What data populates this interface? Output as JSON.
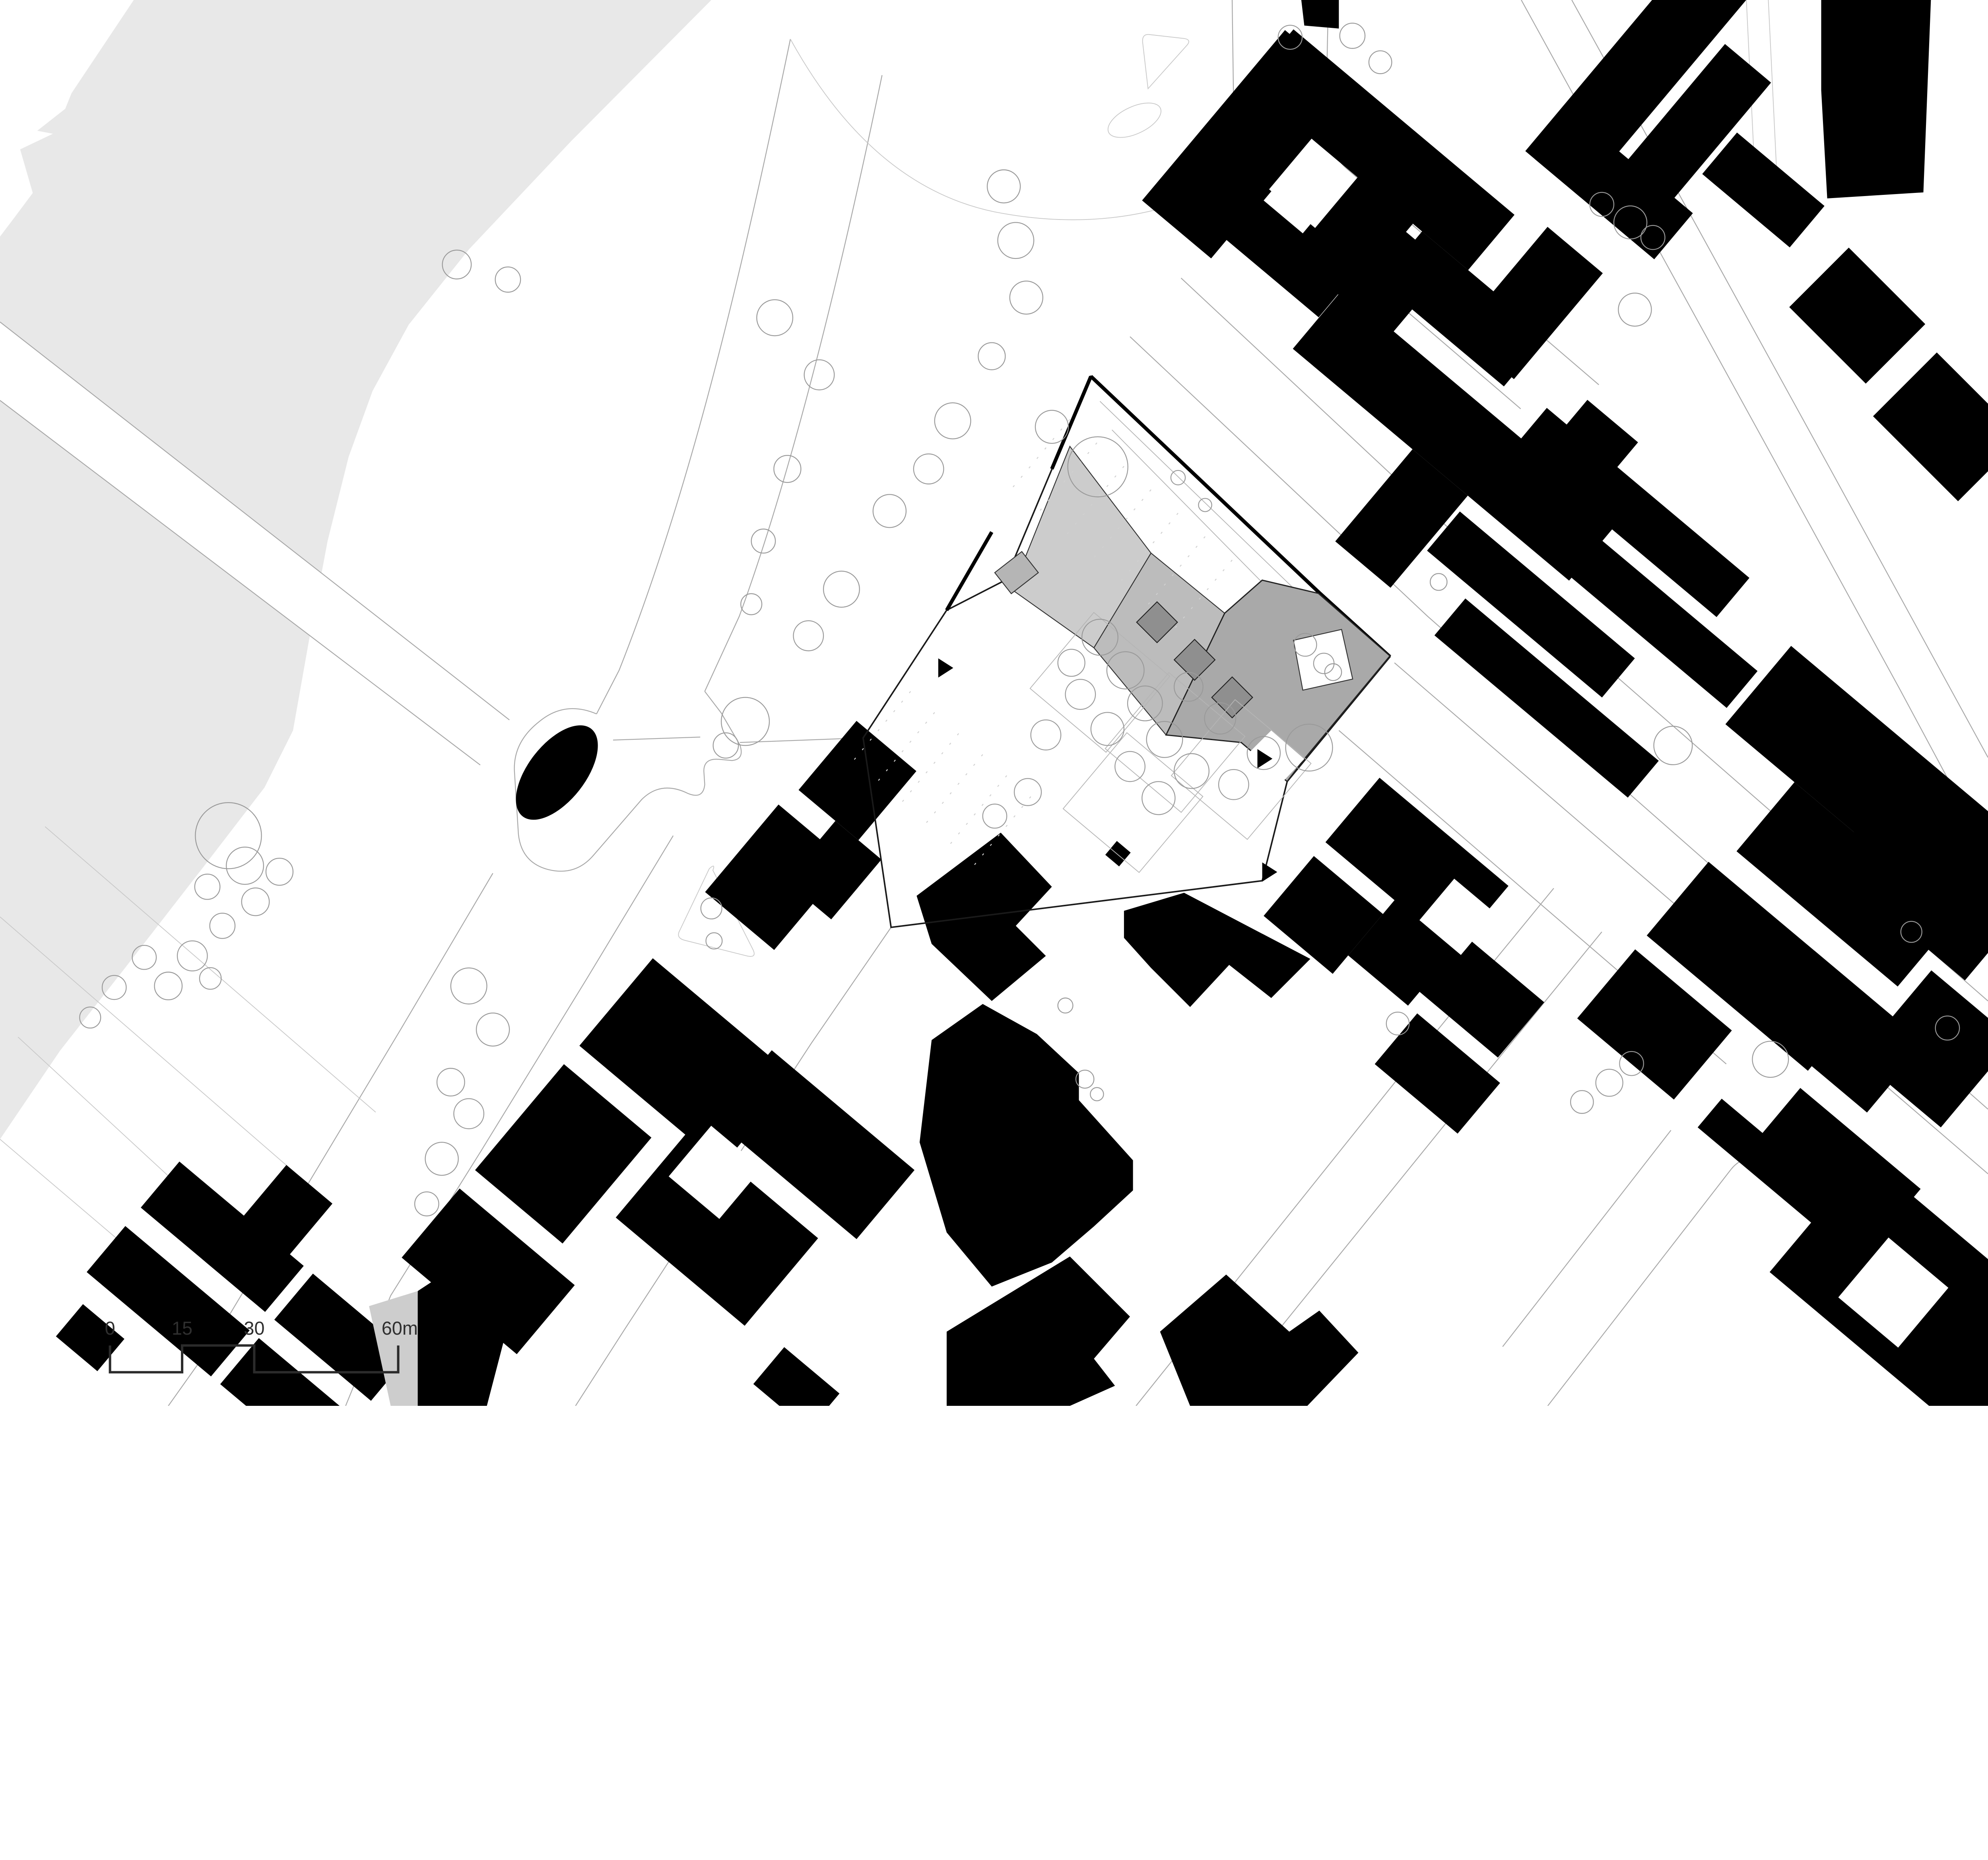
{
  "document": {
    "type": "architectural-site-plan",
    "style": "figure-ground black plan with highlighted project site"
  },
  "scale_bar": {
    "labels": [
      "0",
      "15",
      "30",
      "60m"
    ],
    "values_m": [
      0,
      15,
      30,
      60
    ],
    "unit": "m"
  },
  "colors": {
    "background": "#ffffff",
    "water": "#e8e8e8",
    "building_footprint": "#000000",
    "site_roof_light": "#cccccc",
    "site_roof_mid": "#bcbcbc",
    "site_roof_dark": "#a9a9a9",
    "skylight": "#8f8f8f",
    "tree_outline": "#9a9a9a",
    "road_line": "#a8a8a8",
    "scale_bar": "#2b2b2b"
  },
  "features": {
    "river": "water / river band (top left)",
    "boulevard": "diagonal boulevard with tree rows",
    "site": "project site with terraced grey roofs and courtyard garden",
    "island": "traffic island with black monument oval",
    "buildings": "existing building footprints (black)",
    "scale": "stepped graphic scale bar"
  },
  "trees": [
    [
      2578,
      1057,
      60
    ],
    [
      2726,
      1247,
      50
    ],
    [
      2620,
      1560,
      45
    ],
    [
      2540,
      1800,
      40
    ],
    [
      2500,
      2010,
      35
    ],
    [
      2480,
      2400,
      80
    ],
    [
      2415,
      2480,
      42
    ],
    [
      3340,
      620,
      55
    ],
    [
      3380,
      800,
      60
    ],
    [
      3415,
      990,
      55
    ],
    [
      3300,
      1185,
      45
    ],
    [
      3170,
      1400,
      60
    ],
    [
      3090,
      1560,
      50
    ],
    [
      2960,
      1700,
      55
    ],
    [
      2800,
      1960,
      60
    ],
    [
      2690,
      2115,
      50
    ],
    [
      1520,
      880,
      48
    ],
    [
      1690,
      930,
      42
    ],
    [
      760,
      2780,
      110
    ],
    [
      815,
      2880,
      62
    ],
    [
      690,
      2950,
      42
    ],
    [
      850,
      3000,
      46
    ],
    [
      740,
      3080,
      42
    ],
    [
      640,
      3180,
      50
    ],
    [
      560,
      3280,
      46
    ],
    [
      480,
      3185,
      40
    ],
    [
      700,
      3255,
      36
    ],
    [
      930,
      2900,
      45
    ],
    [
      380,
      3285,
      40
    ],
    [
      300,
      3385,
      35
    ],
    [
      1560,
      3280,
      60
    ],
    [
      1640,
      3425,
      55
    ],
    [
      1500,
      3600,
      46
    ],
    [
      1560,
      3705,
      50
    ],
    [
      1470,
      3855,
      55
    ],
    [
      1420,
      4005,
      40
    ],
    [
      4293,
      124,
      40
    ],
    [
      4500,
      119,
      42
    ],
    [
      4593,
      207,
      38
    ],
    [
      5330,
      680,
      40
    ],
    [
      5425,
      740,
      55
    ],
    [
      5500,
      790,
      40
    ],
    [
      5440,
      1030,
      55
    ],
    [
      4787,
      1936,
      28
    ],
    [
      5567,
      2480,
      64
    ],
    [
      4651,
      3405,
      38
    ],
    [
      5891,
      3524,
      60
    ],
    [
      5264,
      3666,
      38
    ],
    [
      5355,
      3602,
      45
    ],
    [
      5429,
      3538,
      40
    ],
    [
      2367,
      3022,
      35
    ],
    [
      2376,
      3130,
      27
    ],
    [
      3545,
      3345,
      25
    ],
    [
      3610,
      3590,
      30
    ],
    [
      3650,
      3640,
      22
    ],
    [
      3653,
      1553,
      100
    ],
    [
      3500,
      1420,
      55
    ],
    [
      3920,
      1589,
      24
    ],
    [
      4010,
      1680,
      22
    ],
    [
      3660,
      2120,
      60
    ],
    [
      3745,
      2230,
      62
    ],
    [
      3810,
      2340,
      58
    ],
    [
      3685,
      2425,
      55
    ],
    [
      3595,
      2310,
      50
    ],
    [
      3875,
      2460,
      60
    ],
    [
      3965,
      2565,
      58
    ],
    [
      3855,
      2655,
      55
    ],
    [
      3760,
      2550,
      50
    ],
    [
      4060,
      2390,
      52
    ],
    [
      3955,
      2285,
      48
    ],
    [
      4105,
      2610,
      50
    ],
    [
      4205,
      2505,
      55
    ],
    [
      3565,
      2205,
      45
    ],
    [
      3480,
      2445,
      50
    ],
    [
      3420,
      2635,
      45
    ],
    [
      3310,
      2715,
      40
    ],
    [
      4356,
      2487,
      78
    ],
    [
      4343,
      2145,
      38
    ],
    [
      4405,
      2207,
      34
    ],
    [
      4436,
      2236,
      28
    ],
    [
      6480,
      3420,
      40
    ],
    [
      6360,
      3100,
      35
    ]
  ]
}
